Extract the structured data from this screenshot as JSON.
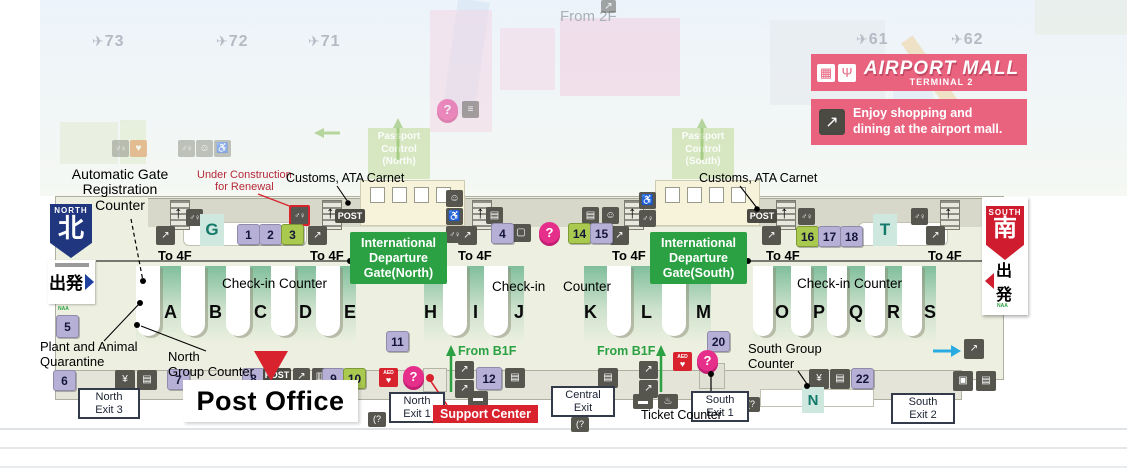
{
  "gates": {
    "g73": "73",
    "g72": "72",
    "g71": "71",
    "g61": "61",
    "g62": "62"
  },
  "from2f": "From 2F",
  "mall": {
    "title": "AIRPORT MALL",
    "subtitle": "TERMINAL 2",
    "promo1": "Enjoy shopping and",
    "promo2": "dining at the airport mall."
  },
  "passport": {
    "l1": "Passport",
    "l2": "Control",
    "n": "(North)",
    "s": "(South)"
  },
  "labels": {
    "autogate1": "Automatic Gate",
    "autogate2": "Registration",
    "autogate3": "Counter",
    "constr1": "Under Construction",
    "constr2": "for Renewal",
    "customs": "Customs, ATA Carnet",
    "checkin": "Check-in Counter",
    "checkin_a": "Check-in",
    "checkin_b": "Counter",
    "plant1": "Plant and Animal",
    "plant2": "Quarantine",
    "ngroup1": "North",
    "ngroup2": "Group Counter",
    "sgroup1": "South Group",
    "sgroup2": "Counter",
    "post_office": "Post Office",
    "support": "Support Center",
    "ticket": "Ticket Counter",
    "fromb1f": "From B1F",
    "to4f": "To 4F",
    "post": "POST"
  },
  "intl_north": {
    "l1": "International",
    "l2": "Departure",
    "l3": "Gate(North)"
  },
  "intl_south": {
    "l1": "International",
    "l2": "Departure",
    "l3": "Gate(South)"
  },
  "signs": {
    "north_en": "NORTH",
    "north_ja": "北",
    "south_en": "SOUTH",
    "south_ja": "南",
    "dep_ja": "出発",
    "naa": "NAA"
  },
  "exits": {
    "n3a": "North",
    "n3b": "Exit 3",
    "n1a": "North",
    "n1b": "Exit 1",
    "ca": "Central",
    "cb": "Exit",
    "s1a": "South",
    "s1b": "Exit 1",
    "s2a": "South",
    "s2b": "Exit 2"
  },
  "counters": {
    "north": [
      "A",
      "B",
      "C",
      "D",
      "E"
    ],
    "mid1": [
      "H",
      "I",
      "J"
    ],
    "mid2": [
      "K",
      "L",
      "M"
    ],
    "south": [
      "O",
      "P",
      "Q",
      "R",
      "S"
    ],
    "g": "G",
    "t": "T",
    "n": "N"
  },
  "numbers": {
    "n1": "1",
    "n2": "2",
    "n3": "3",
    "n4": "4",
    "n5": "5",
    "n6": "6",
    "n7": "7",
    "n8": "8",
    "n9": "9",
    "n10": "10",
    "n11": "11",
    "n12": "12",
    "n14": "14",
    "n15": "15",
    "n16": "16",
    "n17": "17",
    "n18": "18",
    "n20": "20",
    "n22": "22"
  },
  "icons": {
    "plane": "✈",
    "restroom": "♂♀",
    "wheelchair": "♿",
    "baby": "☺",
    "atm": "▤",
    "currency": "¥",
    "escalator": "↗",
    "aed_label": "AED",
    "heart": "♥",
    "question": "?",
    "phone": "(?",
    "smoking": "▬",
    "computer": "▢",
    "elevator": "▣",
    "cart": "▥",
    "stairs": "≡",
    "fountain": "♨",
    "shop": "▦",
    "restaurant": "Ψ",
    "up_arrow": "↑"
  },
  "colors": {
    "accent_pink": "#e9637f",
    "spot_purple": "#b7b0d6",
    "spot_green": "#a9c94f",
    "teal": "#14796b",
    "intl_green": "#2ba143",
    "north_blue": "#20367f",
    "south_red": "#cf1c2f",
    "alert_red": "#d8232f"
  }
}
